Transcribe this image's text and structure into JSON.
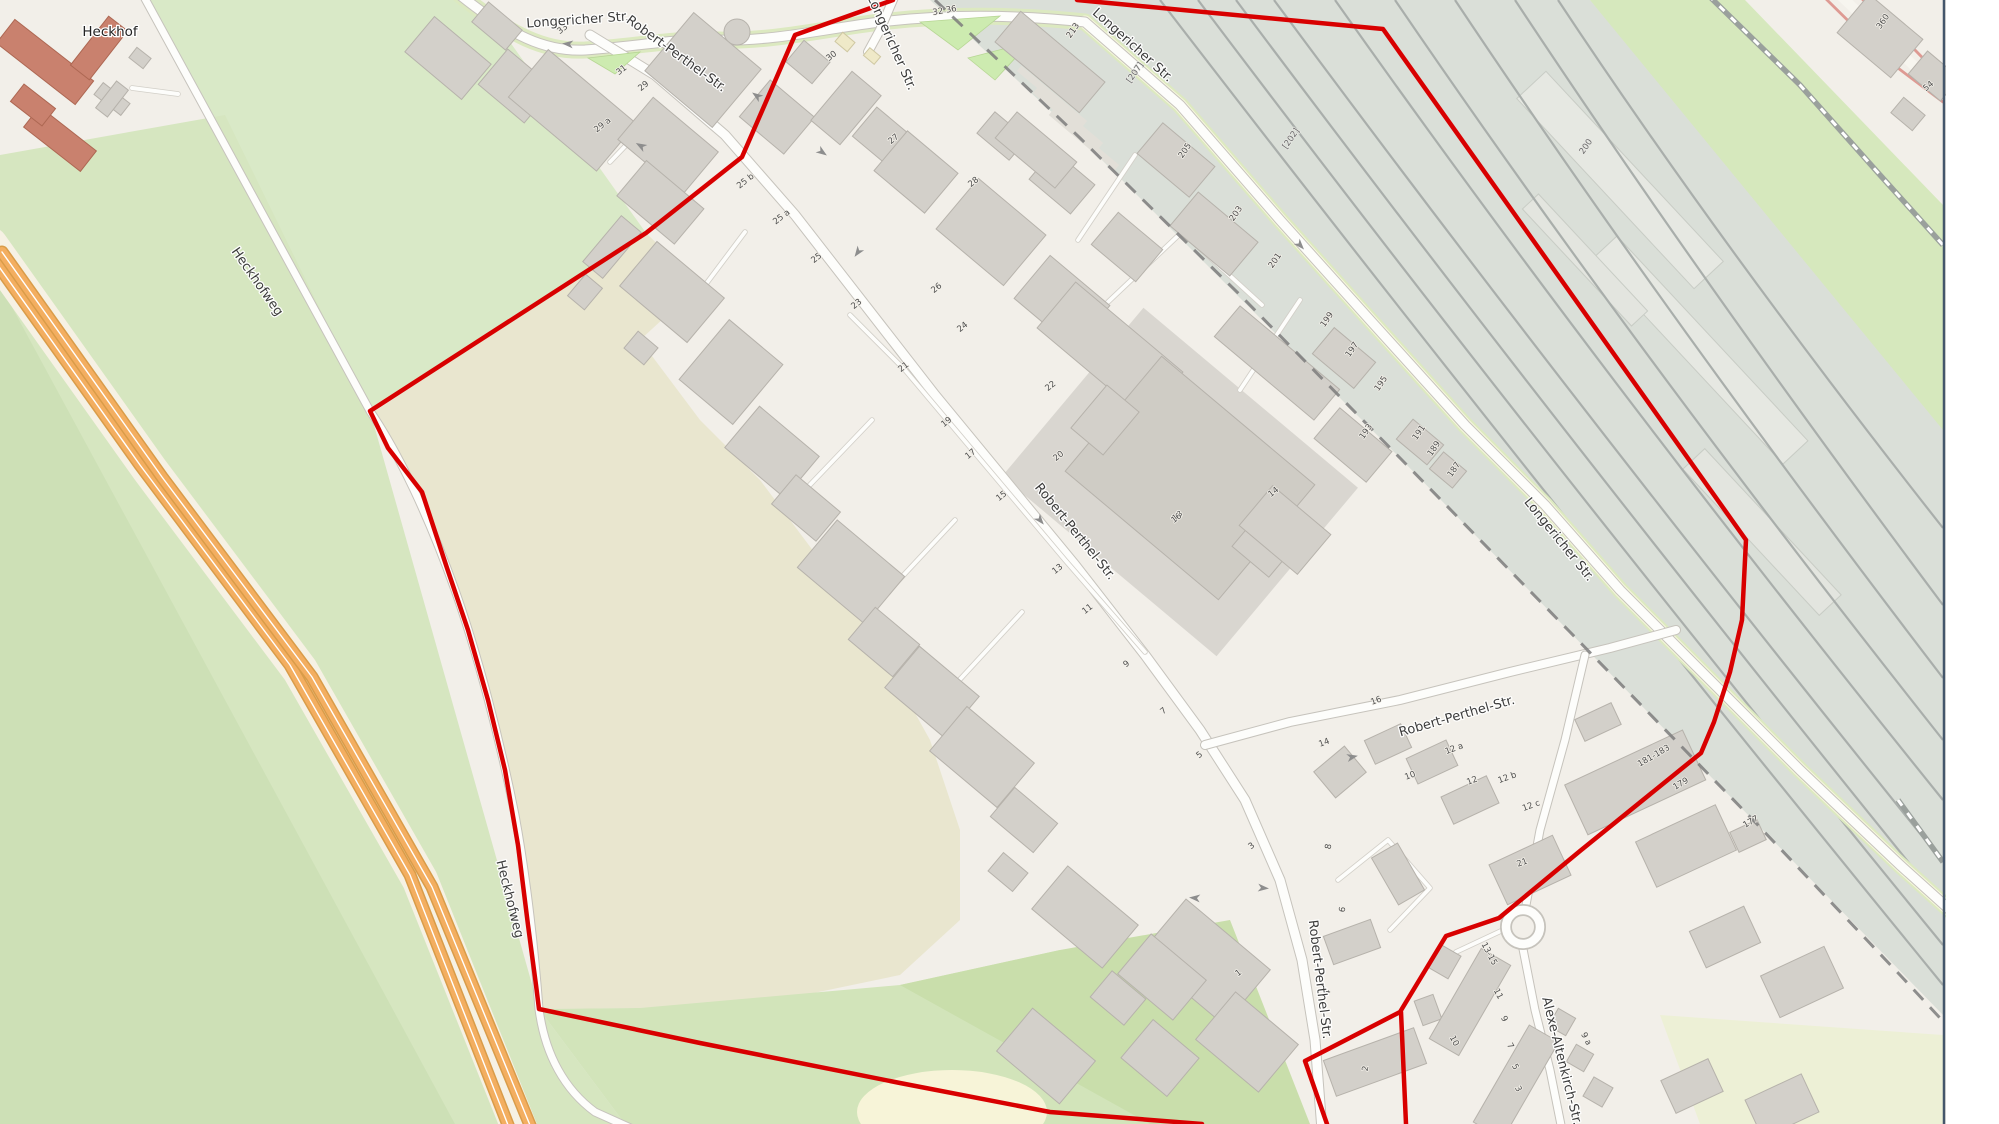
{
  "map": {
    "place_labels": [
      {
        "t": "Heckhof",
        "x": 110,
        "y": 36,
        "r": 0
      }
    ],
    "street_labels": [
      {
        "t": "Longericher Str.",
        "x": 578,
        "y": 24,
        "r": -4
      },
      {
        "t": "Longericher Str.",
        "x": 888,
        "y": 44,
        "r": 66
      },
      {
        "t": "Longericher Str.",
        "x": 1130,
        "y": 48,
        "r": 42
      },
      {
        "t": "Longericher Str.",
        "x": 1556,
        "y": 542,
        "r": 51
      },
      {
        "t": "Robert-Perthel-Str.",
        "x": 674,
        "y": 57,
        "r": 36
      },
      {
        "t": "Robert-Perthel-Str.",
        "x": 1072,
        "y": 534,
        "r": 51
      },
      {
        "t": "Robert-Perthel-Str.",
        "x": 1316,
        "y": 980,
        "r": 83
      },
      {
        "t": "Robert-Perthel-Str.",
        "x": 1458,
        "y": 720,
        "r": -16
      },
      {
        "t": "Alexe-Altenkirch-Str.",
        "x": 1558,
        "y": 1062,
        "r": 76
      },
      {
        "t": "Heckhofweg",
        "x": 254,
        "y": 284,
        "r": 55
      },
      {
        "t": "Heckhofweg",
        "x": 506,
        "y": 900,
        "r": 76
      }
    ],
    "house_numbers": [
      {
        "t": "33",
        "x": 564,
        "y": 31,
        "r": -38
      },
      {
        "t": "31",
        "x": 623,
        "y": 72,
        "r": -38
      },
      {
        "t": "29",
        "x": 645,
        "y": 88,
        "r": -38
      },
      {
        "t": "29 a",
        "x": 604,
        "y": 127,
        "r": -38
      },
      {
        "t": "27",
        "x": 895,
        "y": 141,
        "r": -38
      },
      {
        "t": "25 b",
        "x": 747,
        "y": 183,
        "r": -38
      },
      {
        "t": "25 a",
        "x": 783,
        "y": 219,
        "r": -38
      },
      {
        "t": "25",
        "x": 818,
        "y": 260,
        "r": -38
      },
      {
        "t": "23",
        "x": 858,
        "y": 306,
        "r": -38
      },
      {
        "t": "21",
        "x": 905,
        "y": 369,
        "r": -38
      },
      {
        "t": "19",
        "x": 948,
        "y": 424,
        "r": -38
      },
      {
        "t": "17",
        "x": 972,
        "y": 456,
        "r": -38
      },
      {
        "t": "15",
        "x": 1003,
        "y": 498,
        "r": -38
      },
      {
        "t": "13",
        "x": 1059,
        "y": 571,
        "r": -38
      },
      {
        "t": "11",
        "x": 1089,
        "y": 611,
        "r": -38
      },
      {
        "t": "9",
        "x": 1128,
        "y": 666,
        "r": -38
      },
      {
        "t": "7",
        "x": 1165,
        "y": 713,
        "r": -38
      },
      {
        "t": "5",
        "x": 1201,
        "y": 757,
        "r": -38
      },
      {
        "t": "3",
        "x": 1253,
        "y": 848,
        "r": -38
      },
      {
        "t": "1",
        "x": 1240,
        "y": 975,
        "r": -38
      },
      {
        "t": "30",
        "x": 833,
        "y": 58,
        "r": -38
      },
      {
        "t": "32 36",
        "x": 945,
        "y": 13,
        "r": -10
      },
      {
        "t": "28",
        "x": 975,
        "y": 184,
        "r": -38
      },
      {
        "t": "26",
        "x": 938,
        "y": 290,
        "r": -38
      },
      {
        "t": "24",
        "x": 964,
        "y": 329,
        "r": -38
      },
      {
        "t": "22",
        "x": 1052,
        "y": 388,
        "r": -38
      },
      {
        "t": "20",
        "x": 1060,
        "y": 458,
        "r": -38
      },
      {
        "t": "18",
        "x": 1179,
        "y": 518,
        "r": -38
      },
      {
        "t": "16",
        "x": 1178,
        "y": 520,
        "r": -38
      },
      {
        "t": "14",
        "x": 1275,
        "y": 494,
        "r": -38
      },
      {
        "t": "16",
        "x": 1377,
        "y": 703,
        "r": -20
      },
      {
        "t": "14",
        "x": 1325,
        "y": 745,
        "r": -20
      },
      {
        "t": "12 a",
        "x": 1455,
        "y": 751,
        "r": -20
      },
      {
        "t": "12",
        "x": 1473,
        "y": 783,
        "r": -20
      },
      {
        "t": "12 b",
        "x": 1508,
        "y": 780,
        "r": -20
      },
      {
        "t": "12 c",
        "x": 1532,
        "y": 808,
        "r": -20
      },
      {
        "t": "10",
        "x": 1411,
        "y": 778,
        "r": -20
      },
      {
        "t": "21",
        "x": 1523,
        "y": 865,
        "r": -20
      },
      {
        "t": "8",
        "x": 1331,
        "y": 847,
        "r": -80
      },
      {
        "t": "6",
        "x": 1345,
        "y": 910,
        "r": -80
      },
      {
        "t": "4",
        "x": 1330,
        "y": 993,
        "r": -80
      },
      {
        "t": "2",
        "x": 1368,
        "y": 1069,
        "r": -80
      },
      {
        "t": "13-15",
        "x": 1487,
        "y": 955,
        "r": 62
      },
      {
        "t": "11",
        "x": 1496,
        "y": 995,
        "r": 62
      },
      {
        "t": "9",
        "x": 1502,
        "y": 1020,
        "r": 62
      },
      {
        "t": "7",
        "x": 1508,
        "y": 1047,
        "r": 62
      },
      {
        "t": "5",
        "x": 1513,
        "y": 1068,
        "r": 62
      },
      {
        "t": "3",
        "x": 1516,
        "y": 1090,
        "r": 62
      },
      {
        "t": "10",
        "x": 1452,
        "y": 1042,
        "r": 62
      },
      {
        "t": "9 a",
        "x": 1584,
        "y": 1040,
        "r": 62
      },
      {
        "t": "213",
        "x": 1075,
        "y": 32,
        "r": -55
      },
      {
        "t": "205",
        "x": 1187,
        "y": 152,
        "r": -55
      },
      {
        "t": "203",
        "x": 1238,
        "y": 215,
        "r": -55
      },
      {
        "t": "201",
        "x": 1277,
        "y": 262,
        "r": -55
      },
      {
        "t": "199",
        "x": 1329,
        "y": 321,
        "r": -55
      },
      {
        "t": "197",
        "x": 1354,
        "y": 351,
        "r": -55
      },
      {
        "t": "195",
        "x": 1383,
        "y": 385,
        "r": -55
      },
      {
        "t": "193",
        "x": 1368,
        "y": 433,
        "r": -55
      },
      {
        "t": "191",
        "x": 1421,
        "y": 434,
        "r": -55
      },
      {
        "t": "189",
        "x": 1436,
        "y": 450,
        "r": -55
      },
      {
        "t": "187",
        "x": 1456,
        "y": 471,
        "r": -55
      },
      {
        "t": "181-183",
        "x": 1655,
        "y": 758,
        "r": -30
      },
      {
        "t": "179",
        "x": 1682,
        "y": 786,
        "r": -30
      },
      {
        "t": "177",
        "x": 1752,
        "y": 824,
        "r": -30
      },
      {
        "t": "360",
        "x": 1885,
        "y": 23,
        "r": -55
      },
      {
        "t": "54",
        "x": 1930,
        "y": 88,
        "r": -40
      }
    ],
    "refs": [
      {
        "t": "[207]",
        "x": 1137,
        "y": 74,
        "r": -55
      },
      {
        "t": "[202]",
        "x": 1293,
        "y": 140,
        "r": -55
      },
      {
        "t": "200",
        "x": 1588,
        "y": 148,
        "r": -55
      }
    ],
    "oneway_arrows": [
      {
        "x": 568,
        "y": 44,
        "r": 185
      },
      {
        "x": 641,
        "y": 146,
        "r": 210
      },
      {
        "x": 757,
        "y": 96,
        "r": 215
      },
      {
        "x": 822,
        "y": 152,
        "r": 35
      },
      {
        "x": 858,
        "y": 252,
        "r": 125
      },
      {
        "x": 1040,
        "y": 520,
        "r": 50
      },
      {
        "x": 1300,
        "y": 245,
        "r": 48
      },
      {
        "x": 1195,
        "y": 898,
        "r": 185
      },
      {
        "x": 1263,
        "y": 888,
        "r": 5
      },
      {
        "x": 1352,
        "y": 757,
        "r": -12
      }
    ],
    "boundary": {
      "color": "#d80000",
      "width": 4.5,
      "paths": [
        [
          [
            893,
            0
          ],
          [
            795,
            35
          ],
          [
            742,
            157
          ],
          [
            646,
            233
          ],
          [
            370,
            411
          ],
          [
            388,
            448
          ],
          [
            422,
            492
          ],
          [
            447,
            568
          ],
          [
            468,
            630
          ],
          [
            488,
            700
          ],
          [
            505,
            770
          ],
          [
            518,
            845
          ],
          [
            528,
            925
          ],
          [
            536,
            985
          ],
          [
            539,
            1009
          ],
          [
            700,
            1043
          ],
          [
            900,
            1083
          ],
          [
            1050,
            1112
          ],
          [
            1202,
            1124
          ]
        ],
        [
          [
            1077,
            0
          ],
          [
            1383,
            29
          ],
          [
            1746,
            540
          ],
          [
            1742,
            620
          ],
          [
            1730,
            672
          ],
          [
            1714,
            722
          ],
          [
            1701,
            753
          ],
          [
            1580,
            851
          ],
          [
            1499,
            918
          ],
          [
            1446,
            936
          ],
          [
            1400,
            1012
          ],
          [
            1305,
            1061
          ],
          [
            1327,
            1124
          ]
        ],
        [
          [
            1401,
            1012
          ],
          [
            1406,
            1124
          ]
        ]
      ]
    },
    "colors": {
      "boundary_red": "#d80000",
      "land": "#f2efe9",
      "building": "#d3d0ca",
      "building_stroke": "#b6b2ab",
      "historic_building": "#c9816e",
      "grass": "#cdebb0",
      "green_light": "#d9e9c7",
      "green_mid": "#d6e6c0",
      "farmland": "#e9e6cf",
      "rail_area": "#dadfd8",
      "rail_line": "#a9aeab",
      "motorway_orange": "#f3ae60",
      "road_fill": "#fdfdfb",
      "road_casing": "#c6c3bc",
      "admin_boundary": "#7d7d7d",
      "map_border": "#44566b"
    }
  }
}
